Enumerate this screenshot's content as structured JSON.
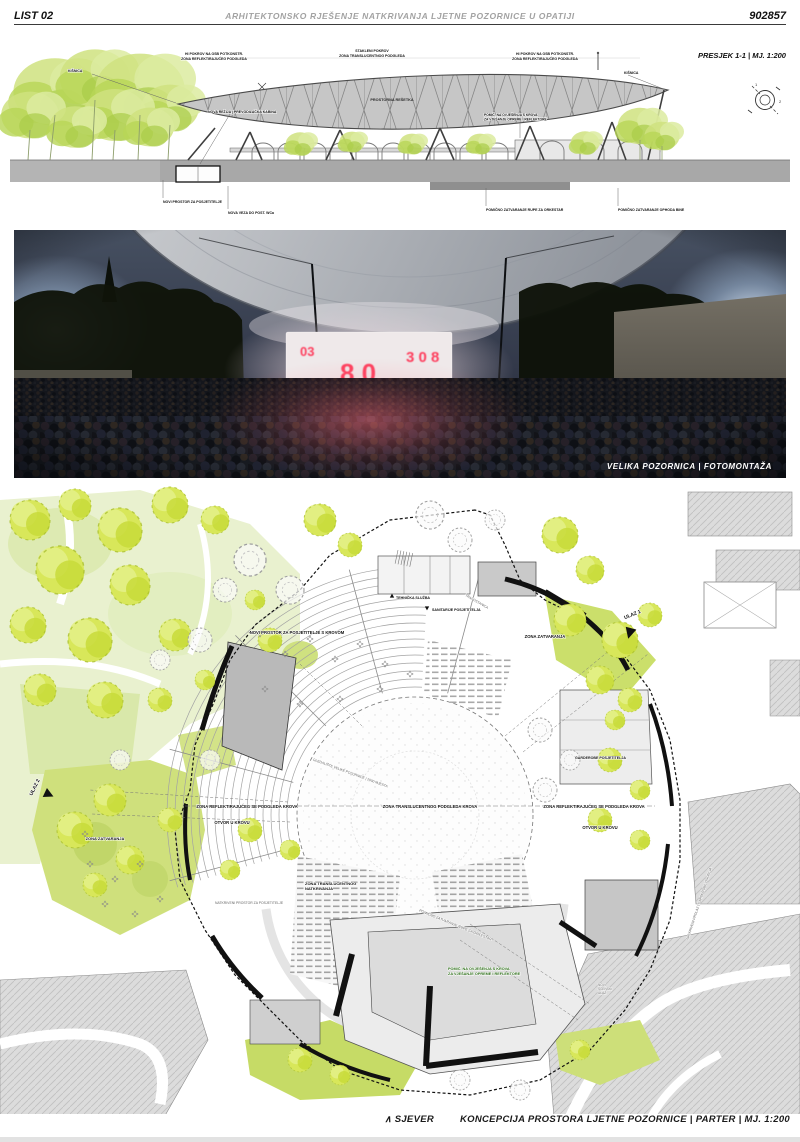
{
  "header": {
    "sheet": "LIST 02",
    "title": "ARHITEKTONSKO RJEŠENJE NATKRIVANJA LJETNE POZORNICE U OPATIJI",
    "code": "902857"
  },
  "section": {
    "caption": "PRESJEK 1-1 | MJ. 1:200",
    "labels": {
      "roof_left_1": "HI POKROV NA OSB POTKONSTR.",
      "roof_left_2": "ZONA REFLEKTIRAJUĆEG PODGLEDA",
      "roof_center_1": "STAKLENI POKROV",
      "roof_center_2": "ZONA TRANSLUCENTNOG PODGLEDA",
      "roof_right_1": "HI POKROV NA OSB POTKONSTR.",
      "roof_right_2": "ZONA REFLEKTIRAJUĆEG PODGLEDA",
      "rainwater": "KIŠNICA",
      "truss": "PROSTORNA REŠETKA",
      "control_room": "NOVA REŽIJA | PREVODILAČKA KABINA",
      "hoist_1": "POMIČ. NA OVJEŠENJA S KROVA",
      "hoist_2": "ZA VJEŠANJE OPREME I REFLEKTORE",
      "new_space": "NOVI PROSTOR ZA POSJETITELJE",
      "wc_link": "NOVA VEZA DO POST. WCa",
      "orchestra_pit": "POMIČNO ZATVARANJE RUPE ZA ORKESTAR",
      "stage_closure": "POMIČNO ZATVARANJE OPHODA BINE"
    },
    "keyplan": {
      "mark_1": "1",
      "mark_2": "2"
    }
  },
  "photo": {
    "caption": "VELIKA POZORNICA | FOTOMONTAŽA",
    "screen_fragments": [
      "03",
      "8 0",
      "3 0 8",
      "8 8",
      "0 3 8"
    ]
  },
  "plan": {
    "north": "∧ SJEVER",
    "caption": "KONCEPCIJA PROSTORA LJETNE POZORNICE | PARTER | MJ. 1:200",
    "labels": {
      "entrance_1": "ULAZ 1",
      "entrance_2": "ULAZ 2",
      "technical": "TEHNIČKA SLUŽBA",
      "substation": "TRAFOSTANICA",
      "sanitary": "SANITARIJE POSJETITELJA",
      "closure_zone": "ZONA ZATVARANJA",
      "new_visitor_space": "NOVI PROSTOR ZA POSJETITELJE S KROVOM",
      "roof_opening": "OTVOR U KROVU",
      "auditorium": "GLEDALIŠTE VELIKE POZORNICE | 2000 MJESTA",
      "translucent_zone": "ZONA TRANSLUCENTNOG PODGLEDA KROVA",
      "reflective_zone": "ZONA REFLEKTIRAJUĆEG SE PODGLEDA KROVA",
      "translucent_cover_1": "ZONA TRANSLUCENTNOG",
      "translucent_cover_2": "NATKRIVANJA",
      "covered_space": "NATKRIVENI PROSTOR ZA POSJETITELJE",
      "orchestra_pit": "POMIČNO ZATVARANJE RUPE ZA ORKESTAR",
      "hoist_1": "POMIČ. NA OVJEŠENJA S KROVA",
      "hoist_2": "ZA VJEŠANJE OPREME I REFLEKTORE",
      "stage_entrance_1": "NOVI",
      "stage_entrance_2": "SCENSKI",
      "stage_entrance_3": "ULAZ",
      "cloakroom": "GARDEROBE POSJETITELJA",
      "covered_passage": "NATKRIVENI PROLAZ | GARDEROBE OSOBLJA"
    }
  },
  "colors": {
    "tree_green": "#d8e75a",
    "field_green": "#e9f1cf",
    "patch_green": "#c6db66",
    "plan_gray": "#dcdcdc",
    "screen_red": "#ff2e50",
    "ink": "#111111"
  }
}
